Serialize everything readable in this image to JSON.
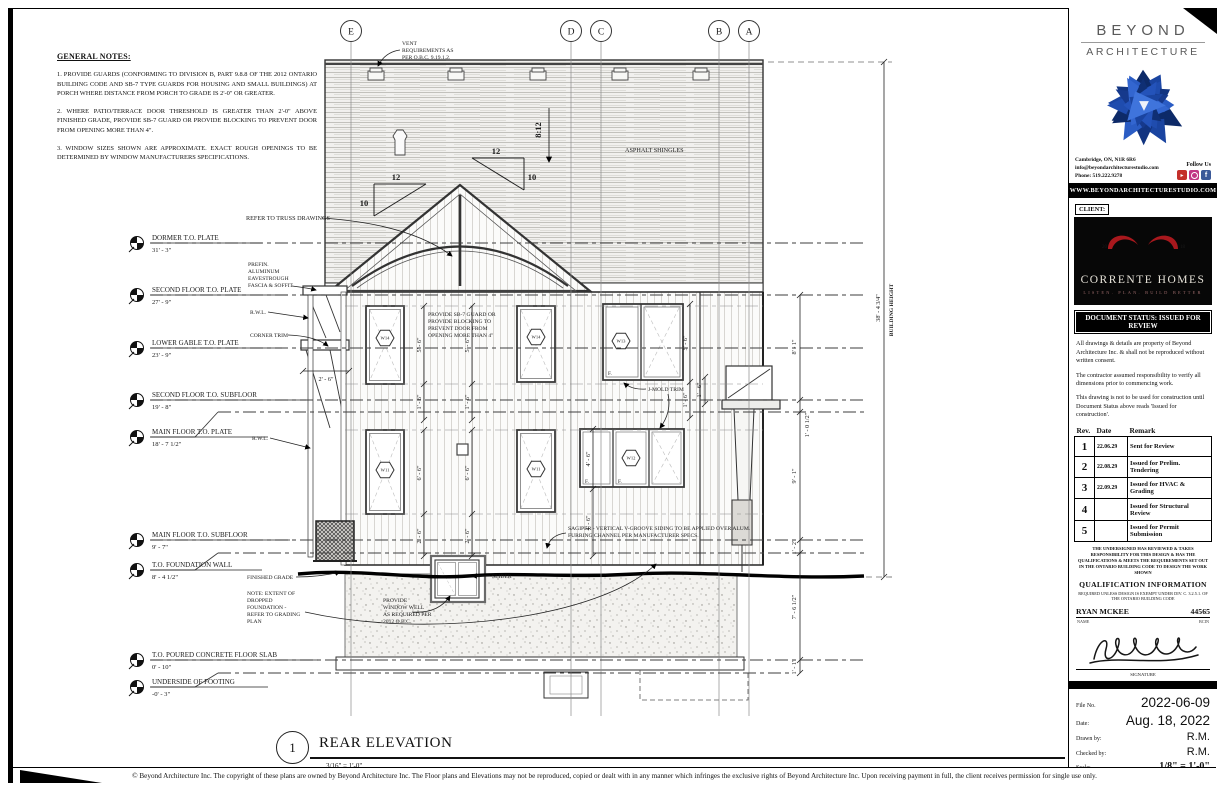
{
  "general_notes": {
    "title": "GENERAL NOTES:",
    "notes": [
      "1.   PROVIDE GUARDS (CONFORMING TO DIVISION B, PART 9.8.8 OF THE 2012 ONTARIO BUILDING CODE AND SB-7 TYPE GUARDS FOR HOUSING AND SMALL BUILDINGS) AT PORCH WHERE DISTANCE FROM PORCH TO GRADE IS 2'-0\" OR GREATER.",
      "2.   WHERE PATIO/TERRACE DOOR THRESHOLD IS GREATER THAN 2'-0\" ABOVE FINISHED GRADE, PROVIDE SB-7 GUARD OR PROVIDE BLOCKING TO PREVENT DOOR FROM OPENING MORE THAN 4\".",
      "3.   WINDOW SIZES SHOWN ARE APPROXIMATE.  EXACT ROUGH OPENINGS TO BE DETERMINED BY WINDOW MANUFACTURERS SPECIFICATIONS."
    ]
  },
  "drawing": {
    "grid": [
      "E",
      "D",
      "C",
      "B",
      "A"
    ],
    "levels": [
      {
        "label": "DORMER T.O. PLATE",
        "elev": "31' - 3\""
      },
      {
        "label": "SECOND FLOOR T.O. PLATE",
        "elev": "27' - 9\""
      },
      {
        "label": "LOWER GABLE T.O. PLATE",
        "elev": "23' - 9\""
      },
      {
        "label": "SECOND FLOOR T.O. SUBFLOOR",
        "elev": "19' - 8\""
      },
      {
        "label": "MAIN FLOOR T.O. PLATE",
        "elev": "18' - 7 1/2\""
      },
      {
        "label": "MAIN FLOOR T.O. SUBFLOOR",
        "elev": "9' - 7\""
      },
      {
        "label": "T.O. FOUNDATION WALL",
        "elev": "8' - 4 1/2\""
      },
      {
        "label": "T.O. POURED CONCRETE FLOOR SLAB",
        "elev": "0' - 10\""
      },
      {
        "label": "UNDERSIDE OF FOOTING",
        "elev": "-0' - 3\""
      }
    ],
    "notes": {
      "vent": [
        "VENT",
        "REQUIREMENTS AS",
        "PER O.B.C. 9.19.1.2."
      ],
      "truss": "REFER TO TRUSS DRAWINGS",
      "eaves": [
        "PREFIN.",
        "ALUMINUM",
        "EAVESTROUGH",
        "FASCIA & SOFFIT"
      ],
      "rwl": "R.W.L.",
      "corner_trim": "CORNER TRIM",
      "sb7": [
        "PROVIDE SB-7 GUARD OR",
        "PROVIDE BLOCKING TO",
        "PREVENT DOOR FROM",
        "OPENING MORE THAN 4\""
      ],
      "jmold": "J-MOLD TRIM",
      "asphalt": "ASPHALT SHINGLES",
      "sagiper": [
        "SAGIPER - VERTICAL V-GROOVE SIDING TO BE APPLIED OVER ALUM.",
        "FURRING CHANNEL PER MANUFACTURER SPECS."
      ],
      "window_well": [
        "PROVIDE",
        "WINDOW WELL",
        "AS REQUIRED PER",
        "2012 O.B.C."
      ],
      "dropped_foundation": [
        "NOTE: EXTENT OF",
        "DROPPED",
        "FOUNDATION -",
        "REFER TO GRADING",
        "PLAN"
      ],
      "finished_grade": "FINISHED GRADE",
      "slider": "SLIDER",
      "pane": "F."
    },
    "slopes": {
      "main": "8:12",
      "run": "12",
      "rise": "10"
    },
    "tags": {
      "w11": "W11",
      "w12": "W12",
      "w13": "W13",
      "w14": "W14"
    },
    "dims": {
      "right_inner": [
        "8' - 1\"",
        "1' - 0 1/2\"",
        "9' - 1\"",
        "1' - 2\"",
        "7' - 6 1/2\"",
        "1' - 1\""
      ],
      "building_height_value": "38' - 4 3/4\"",
      "building_height_label": "BUILDING HEIGHT",
      "win_upper_h": "5' - 6\"",
      "win_upper_sill": "1' - 6\"",
      "win_main_h": "6' - 6\"",
      "win_main_sill": "2' - 6\"",
      "win_triple_h": "4' - 6\"",
      "win_triple_sill": "4' - 6\"",
      "bay": "1' - 6\"",
      "porch": "2' - 6\""
    }
  },
  "view_title": {
    "number": "1",
    "name": "REAR ELEVATION",
    "scale": "3/16\" = 1'-0\""
  },
  "titleblock": {
    "brand": {
      "line1": "BEYOND",
      "line2": "ARCHITECTURE",
      "address": "Cambridge, ON, N1R 6R6",
      "email": "info@beyondarchitecturestudio.com",
      "phone": "Phone: 519.222.9278",
      "follow": "Follow Us",
      "website": "WWW.BEYONDARCHITECTURESTUDIO.COM"
    },
    "client": {
      "label": "CLIENT:",
      "name": "CORRENTE HOMES",
      "tagline": "LISTEN. PLAN. BUILD BETTER",
      "year_left": "20",
      "year_right": "18"
    },
    "status": "DOCUMENT STATUS: ISSUED FOR REVIEW",
    "disclaimers": [
      "All drawings & details are property of Beyond Architecture Inc. & shall not be reproduced without written consent.",
      "The contractor assumed responsibility to verify all dimensions prior to commencing work.",
      "This drawing is not to be used for construction until Document Status above reads 'Issued for construction'."
    ],
    "revisions": {
      "headers": [
        "Rev.",
        "Date",
        "Remark"
      ],
      "rows": [
        {
          "rev": "1",
          "date": "22.06.29",
          "remark": "Sent for Review"
        },
        {
          "rev": "2",
          "date": "22.08.29",
          "remark": "Issued for Prelim. Tendering"
        },
        {
          "rev": "3",
          "date": "22.09.29",
          "remark": "Issued for HVAC & Grading"
        },
        {
          "rev": "4",
          "date": "",
          "remark": "Issued for Structural Review"
        },
        {
          "rev": "5",
          "date": "",
          "remark": "Issued for Permit Submission"
        }
      ]
    },
    "qualification": {
      "statement": "THE UNDERSIGNED HAS REVIEWED & TAKES RESPONSIBILITY FOR THIS DESIGN & HAS THE QUALIFICATIONS & MEETS THE REQUIREMENTS SET OUT IN THE ONTARIO BUILDING CODE TO DESIGN THE WORK SHOWN",
      "heading": "QUALIFICATION INFORMATION",
      "subnote": "REQUIRED UNLESS DESIGN IS EXEMPT UNDER DIV. C. 3.2.5.1. OF THE ONTARIO BUILDING CODE",
      "name": "RYAN MCKEE",
      "bcin": "44565",
      "name_label": "NAME",
      "bcin_label": "BCIN",
      "signature_label": "SIGNATURE"
    },
    "fileinfo": {
      "file_no_label": "File No.",
      "file_no": "2022-06-09",
      "date_label": "Date:",
      "date": "Aug. 18, 2022",
      "drawn_label": "Drawn by:",
      "drawn": "R.M.",
      "checked_label": "Checked by:",
      "checked": "R.M.",
      "scale_label": "Scale:",
      "scale": "1/8\" = 1'-0\"",
      "sheet": "A3.04"
    }
  },
  "copyright": "© Beyond Architecture Inc. The copyright of these plans are owned by Beyond Architecture Inc. The Floor plans and Elevations may not be reproduced, copied or dealt with in any manner which infringes the exclusive rights of Beyond Architecture Inc. Upon receiving payment in full, the client receives permission for single use only."
}
